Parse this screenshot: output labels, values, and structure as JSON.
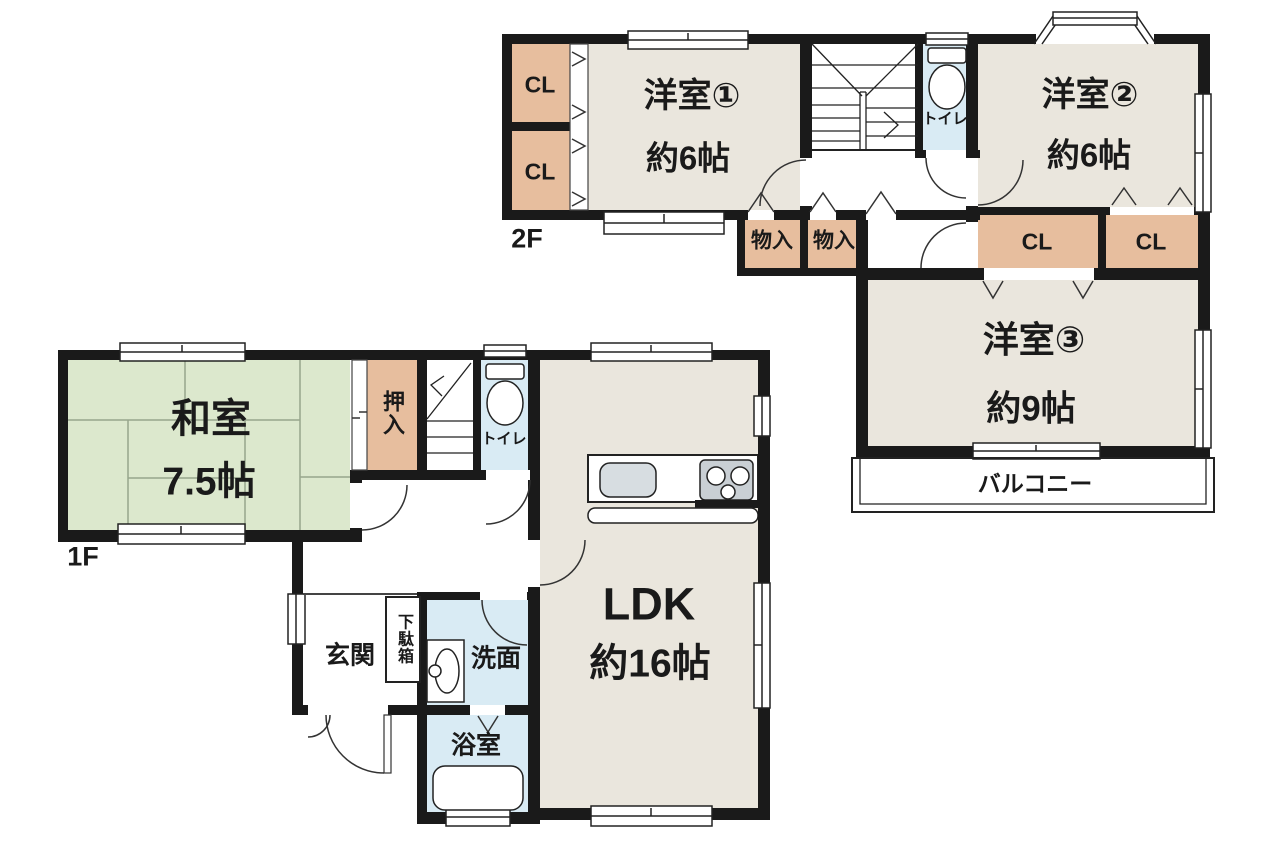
{
  "palette": {
    "wall": "#1a1a1a",
    "line": "#222222",
    "room_beige": "#EAE6DD",
    "tatami_green": "#DCE8CD",
    "closet_tan": "#E7BE9E",
    "wet_blue": "#D9EBF4",
    "fixture_gray": "#C9CFD4",
    "sink_gray": "#D7DDE1",
    "white": "#FFFFFF"
  },
  "floors": {
    "f2": {
      "label": "2F",
      "rooms": {
        "yoshitsu1": {
          "name": "洋室①",
          "area": "約6帖"
        },
        "yoshitsu2": {
          "name": "洋室②",
          "area": "約6帖"
        },
        "yoshitsu3": {
          "name": "洋室③",
          "area": "約9帖"
        }
      },
      "closet_labels": [
        "CL",
        "CL",
        "CL",
        "CL"
      ],
      "storage_labels": [
        "物入",
        "物入"
      ],
      "toilet_label": "トイレ",
      "balcony_label": "バルコニー"
    },
    "f1": {
      "label": "1F",
      "rooms": {
        "washitsu": {
          "name": "和室",
          "area": "7.5帖"
        },
        "ldk": {
          "name": "LDK",
          "area": "約16帖"
        }
      },
      "oshiire_label": "押入",
      "toilet_label": "トイレ",
      "genkan_label": "玄関",
      "getabako_label": "下駄箱",
      "senmen_label": "洗面",
      "bath_label": "浴室"
    }
  }
}
